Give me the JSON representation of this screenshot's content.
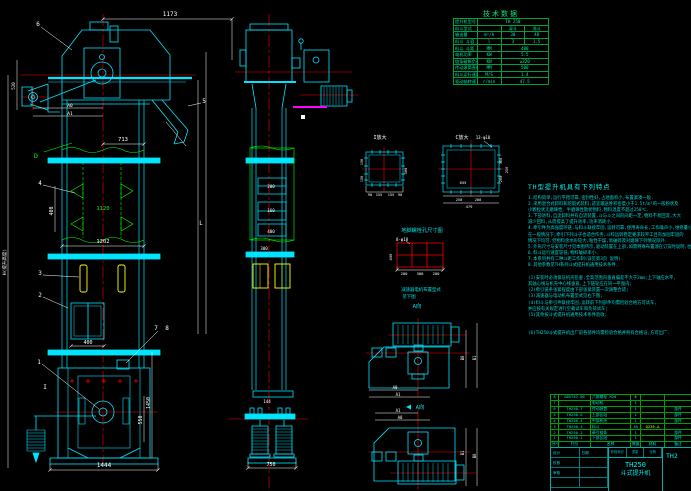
{
  "colors": {
    "background": "#000000",
    "main_line": "#00e5ff",
    "dimension": "#ffffff",
    "centerline": "#ff0000",
    "aux_green": "#00ff00",
    "bucket_yellow": "#ffff00",
    "motor_underline": "#ff00ff",
    "table_line_green": "#00a040",
    "highlight": "#d8ff00"
  },
  "fv": {
    "dim_1173": "1173",
    "dim_520": "520",
    "dim_713": "713",
    "dim_400_pitch": "400",
    "dim_1120": "1120",
    "dim_1202": "1202",
    "dim_400_door": "400",
    "dim_1444": "1444",
    "dim_1450": "1450",
    "dim_550": "550",
    "dim_H": "H(提升高度)",
    "dim_L": "L",
    "a0": "A0",
    "a1": "A1",
    "p1": "1",
    "p2": "2",
    "p3": "3",
    "p4": "4",
    "p5": "5",
    "p6": "6",
    "p7": "7",
    "p8": "8",
    "sec_D": "D",
    "sec_I": "I"
  },
  "sv": {
    "d200": "200",
    "d160": "160",
    "d400": "400",
    "d300": "300",
    "d144": "144",
    "d750": "750"
  },
  "details": {
    "fl1_label": "I放大",
    "fl1_d90a": "90",
    "fl1_d155a": "155",
    "fl1_d155b": "155",
    "fl1_d90b": "90",
    "fl1_d300": "300",
    "fl1_d150a": "150",
    "fl1_d150b": "150",
    "fl2_label": "C放大",
    "fl2_bolt": "13-φ18",
    "fl2_d655": "655",
    "fl2_d250a": "250",
    "fl2_d200a": "200",
    "fl2_d479": "479",
    "fl2_d300": "300",
    "fl2_d200b": "200",
    "fl2_d250c": "250",
    "caption": "地脚螺栓孔尺寸图",
    "grid_bolt": "8-φ18",
    "grid_d450": "450",
    "grid_d200a": "200",
    "grid_d300": "300",
    "grid_d200b": "200",
    "note1": "减速器电机布置型式",
    "note2": "见下图",
    "a_dir1": "A向",
    "a_dir2": "A向",
    "pv1_a0": "A0",
    "pv1_a1": "A1",
    "pv1_b0": "B0",
    "pv1_b1": "B1",
    "pv2_a0": "A0",
    "pv2_a1": "A1",
    "pv2_b0": "B0",
    "pv2_b1": "B1"
  },
  "tech": {
    "title": "技术数据",
    "rows": [
      {
        "label": "提升机型号",
        "value": "TH 250"
      },
      {
        "label": "料斗型式",
        "v1": "深斗",
        "v2": "浅斗"
      },
      {
        "label": "输送量",
        "unit": "m³/h",
        "v1": "30",
        "v2": "48"
      },
      {
        "label": "料斗 斗容",
        "unit": "l",
        "v1": "3",
        "v2": "1.5"
      },
      {
        "label": "料斗 斗距",
        "unit": "MM",
        "value": "480"
      },
      {
        "label": "电机功率",
        "unit": "KW",
        "value": "5.5"
      },
      {
        "label": "链条破断负荷",
        "unit": "KN",
        "value": "≥320"
      },
      {
        "label": "传动滚筒直径",
        "unit": "MM",
        "value": "500"
      },
      {
        "label": "料斗运行速度",
        "unit": "M/S",
        "value": "1.4"
      },
      {
        "label": "驱动轴转速",
        "unit": "r/min",
        "value": "47.5"
      }
    ]
  },
  "notes": {
    "title": "TH型提升机具有下列特点",
    "lines": [
      "1.结构简单,运行平稳可靠,密封性好,占地面积小,布置紧凑一般.",
      "2.采用混合式卸料和挖取式装料,适宜输送堆积密度小于1.5t/m³的一般粉状及",
      "  小颗粒状无磨琢性、半磨琢性散状物料,物料温度不超过250℃.",
      "3.下部进料,自流卸料并有自流装置,斗与斗之间的间距一定,物料不易回流,大大",
      "  减少回料,从而提高了提升效率,功率消耗小.",
      "4.牵引件为高强度环链,与料斗联接牢固,运转可靠,使用寿命长,工作噪声小,维修量小.",
      "  在一般情况下,牵引下列斗子也适合作务,斗料运转稳定要求较平工且有加固牢固的",
      "  情况下均可.但物料含水份较大,粘性干燥,易破碎及对磨琢下列情况除外.",
      "5.外形尺寸与安装尺寸见本图所示,驱动装置在上部,如需特殊布置须在订货时说明,也可",
      "6.料斗运行速度较低,物料破碎率小.",
      "7.本系列共有二种斗距工作制(详见第3页 说明).",
      "8.其他参数见TH系列斗式提升机通用技术条件.",
      "(1)安装时必须保证机壳铅垂,全高范围内垂直偏差不大于2mm;上下轴应水平,",
      "   其轴心线与机壳中心线垂直,上下链轮应在同一平面内;",
      "(2)牵引链条张紧程度由下部张紧装置一次调整合适;",
      "(3)减速器与电动机布置型式见右下图;",
      "(4)料斗与牵引件联接牢固,运转前下列部件均需检验合格方可试车,",
      "   并应按有关规定进行空载试车和负荷试车;",
      "(5)其余按斗式提升机通用技术条件验收;",
      "(6)TH250斗式提升机出厂前各部件均需检验合格并附有合格证,方可出厂."
    ]
  },
  "bom": {
    "headers": [
      "序号",
      "代号",
      "名称",
      "数量",
      "材料",
      "备注"
    ],
    "rows": [
      [
        "8",
        "GB5782-86",
        "六角螺栓 M20",
        "4",
        "",
        ""
      ],
      [
        "7",
        "",
        "电动机",
        "1",
        "",
        ""
      ],
      [
        "6",
        "TH250.7",
        "传动装置",
        "1",
        "",
        "部件"
      ],
      [
        "5",
        "TH250.6",
        "上部区段",
        "1",
        "",
        "部件"
      ],
      [
        "4",
        "TH250.4",
        "中部机壳",
        "1",
        "",
        "部件"
      ],
      [
        "3",
        "TH250.3",
        "料斗",
        "38",
        "Q235-A",
        ""
      ],
      [
        "2",
        "TH250.2",
        "牵引链条",
        "1",
        "",
        "部件"
      ],
      [
        "1",
        "TH250.1",
        "下部区段",
        "1",
        "",
        "部件"
      ]
    ]
  },
  "titleblock": {
    "model": "TH250",
    "product": "斗式提升机",
    "drawing_no": "TH2",
    "stage": "阶段标记",
    "weight": "重量",
    "scale": "比例",
    "sigs": [
      "设计",
      "校核",
      "审核",
      "日期"
    ]
  }
}
